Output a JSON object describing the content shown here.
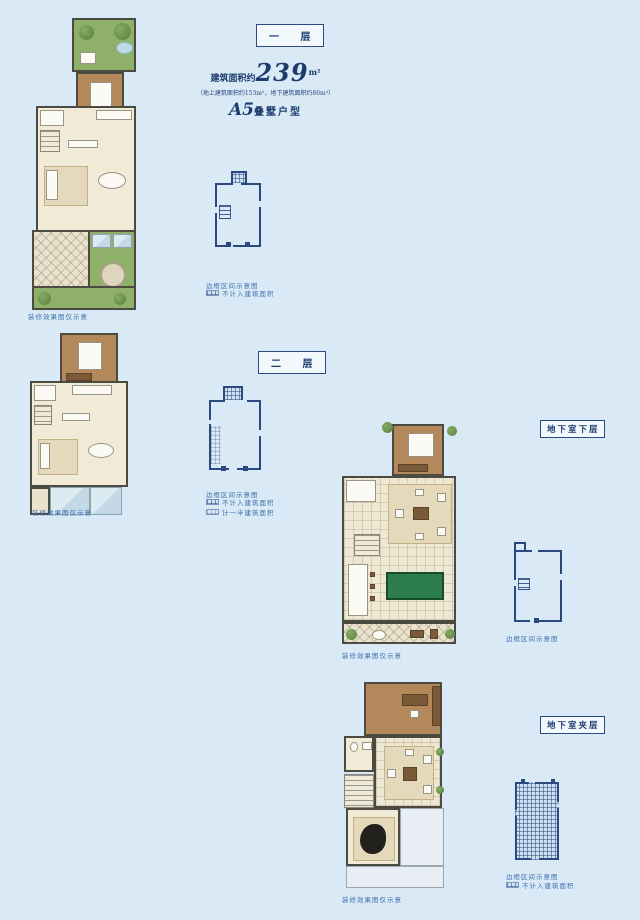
{
  "colors": {
    "background": "#d9eaf6",
    "accent_navy": "#2a4a7f",
    "caption_blue": "#3f6fae",
    "garden_green": "#8fb069",
    "billiard_green": "#2e7d4c"
  },
  "floor1": {
    "label": "一 层",
    "area_prefix": "建筑面积约",
    "area_value": "239",
    "area_unit": "m²",
    "area_note": "（地上建筑面积约153m²，地下建筑面积约86m²）",
    "type_value": "A5",
    "type_suffix": "叠墅户型",
    "plan_caption": "装修效果图仅示意",
    "keyplan_caption": "边框区间示意图",
    "legend": [
      "不计入建筑面积"
    ]
  },
  "floor2": {
    "label": "二 层",
    "plan_caption": "装修效果图仅示意",
    "keyplan_caption": "边框区间示意图",
    "legend": [
      "不计入建筑面积",
      "计一半建筑面积"
    ]
  },
  "basement_lower": {
    "label": "地下室下层",
    "plan_caption": "装修效果图仅示意",
    "keyplan_caption": "边框区间示意图"
  },
  "basement_mezzanine": {
    "label": "地下室夹层",
    "plan_caption": "装修效果图仅示意",
    "keyplan_caption": "边框区间示意图",
    "legend": [
      "不计入建筑面积"
    ]
  }
}
